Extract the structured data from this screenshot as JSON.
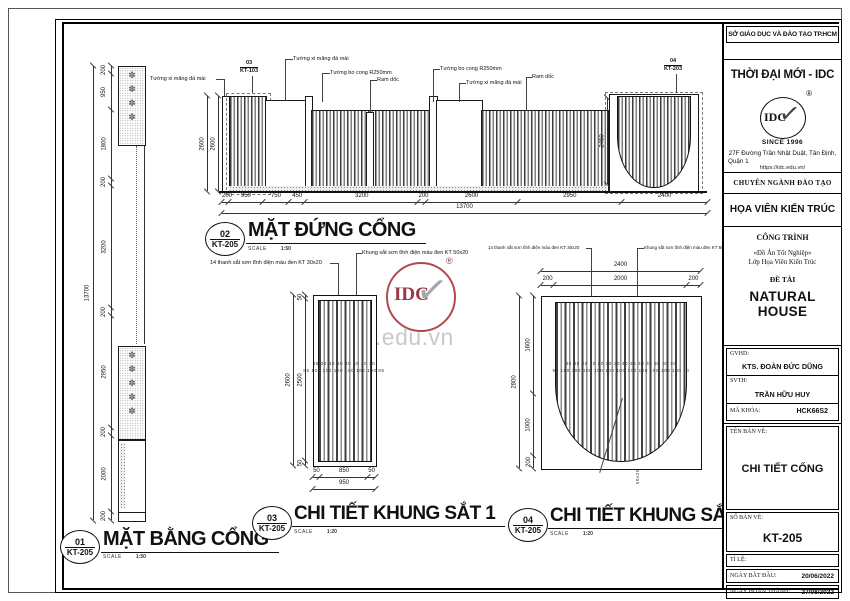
{
  "titleblock": {
    "agency": "SỞ GIÁO DỤC VÀ ĐÀO TẠO TP.HCM",
    "org": "THỜI ĐẠI MỚI - IDC",
    "logo": {
      "text": "IDC",
      "since": "SINCE 1996",
      "reg": "®",
      "check": "✓"
    },
    "address1": "27F Đường Trần Nhật Duật, Tân Định,",
    "address2": "Quận 1",
    "website": "https://idc.edu.vn/",
    "major_label": "CHUYÊN NGÀNH ĐÀO TẠO",
    "major": "HỌA VIÊN KIẾN TRÚC",
    "project_label": "CÔNG TRÌNH",
    "project1": "«Đồ Án Tốt Nghiệp»",
    "project2": "Lớp Họa Viên Kiến Trúc",
    "topic_label": "ĐỀ TÀI",
    "topic": "NATURAL HOUSE",
    "gvhd_label": "GVHD:",
    "gvhd": "KTS. ĐOÀN ĐỨC DŨNG",
    "svth_label": "SVTH:",
    "svth": "TRẦN HỮU HUY",
    "class_label": "MÃ KHÓA:",
    "class_code": "HCK66S2",
    "name_label": "TÊN BẢN VẼ:",
    "drawing_name": "CHI TIẾT CỔNG",
    "number_label": "SỐ BẢN VẼ:",
    "number": "KT-205",
    "scale_label": "TỈ LỆ:",
    "start_label": "NGÀY BẮT ĐẦU:",
    "start": "20/06/2022",
    "end_label": "NGÀY HOÀN THÀNH:",
    "end": "27/08/2022"
  },
  "watermark": {
    "logo": "IDC",
    "reg": "®",
    "check": "✓",
    "site": "idc.edu.vn"
  },
  "plan": {
    "num": "01",
    "sheet": "KT-205",
    "title": "MẶT BẰNG CỔNG",
    "scale_label": "SCALE",
    "scale": "1:50",
    "dims": [
      "200",
      "950",
      "1800",
      "200",
      "3200",
      "200",
      "2950",
      "200",
      "2000",
      "200"
    ],
    "total": "13700",
    "flowers_top": "✽✽✽✽",
    "flowers_bottom": "✽✽✽✽✽"
  },
  "elevation": {
    "num": "02",
    "sheet": "KT-205",
    "title": "MẶT ĐỨNG CỔNG",
    "scale_label": "SCALE",
    "scale": "1:50",
    "lbl_wall": "Tường xi măng đá mài",
    "lbl_curve": "Tường bo cong R250mm",
    "lbl_ramp": "Ram dốc",
    "callout1_num": "03",
    "callout1_sheet": "KT-103",
    "callout2_num": "04",
    "callout2_sheet": "KT-203",
    "dim_left_a": "2600",
    "dim_left_b": "2600",
    "dim_right": "2450",
    "dims": [
      "200",
      "950",
      "750",
      "450",
      "3200",
      "200",
      "2600",
      "2950",
      "2400"
    ],
    "total": "13700"
  },
  "detail1": {
    "num": "03",
    "sheet": "KT-205",
    "title": "CHI TIẾT KHUNG SẮT 1",
    "scale_label": "SCALE",
    "scale": "1:20",
    "lbl_bars": "14 thanh sắt sơn tĩnh điện màu đen KT 30x20",
    "lbl_frame": "Khung sắt sơn tĩnh điện màu đen KT 50x20",
    "dims_left": [
      "50",
      "2500",
      "50"
    ],
    "left_total": "2600",
    "mini_top": "30 30 30 30 30 30 30 30",
    "mini_bot": "85 100 100 100 100 100 100 85",
    "dims_bottom": [
      "50",
      "850",
      "50"
    ],
    "bottom_total": "950"
  },
  "detail2": {
    "num": "04",
    "sheet": "KT-205",
    "title": "CHI TIẾT KHUNG SẮT 2",
    "scale_label": "SCALE",
    "scale": "1:20",
    "lbl_bars": "14 thanh sắt sơn tĩnh điện màu đen KT 30x20",
    "lbl_frame": "Khung sắt sơn tĩnh điện màu đen KT 50x20",
    "dims_top": [
      "200",
      "2000",
      "200"
    ],
    "top_total": "2400",
    "dims_left": [
      "1600",
      "1000",
      "200"
    ],
    "left_total": "2800",
    "mini_top": "30 30 30 30 30 30 30 30 30 30 30 30 30 30",
    "mini_bot": "90 100 100 100 100 100 100 100 100 100 100 100 90",
    "leader_size": "50x20"
  }
}
